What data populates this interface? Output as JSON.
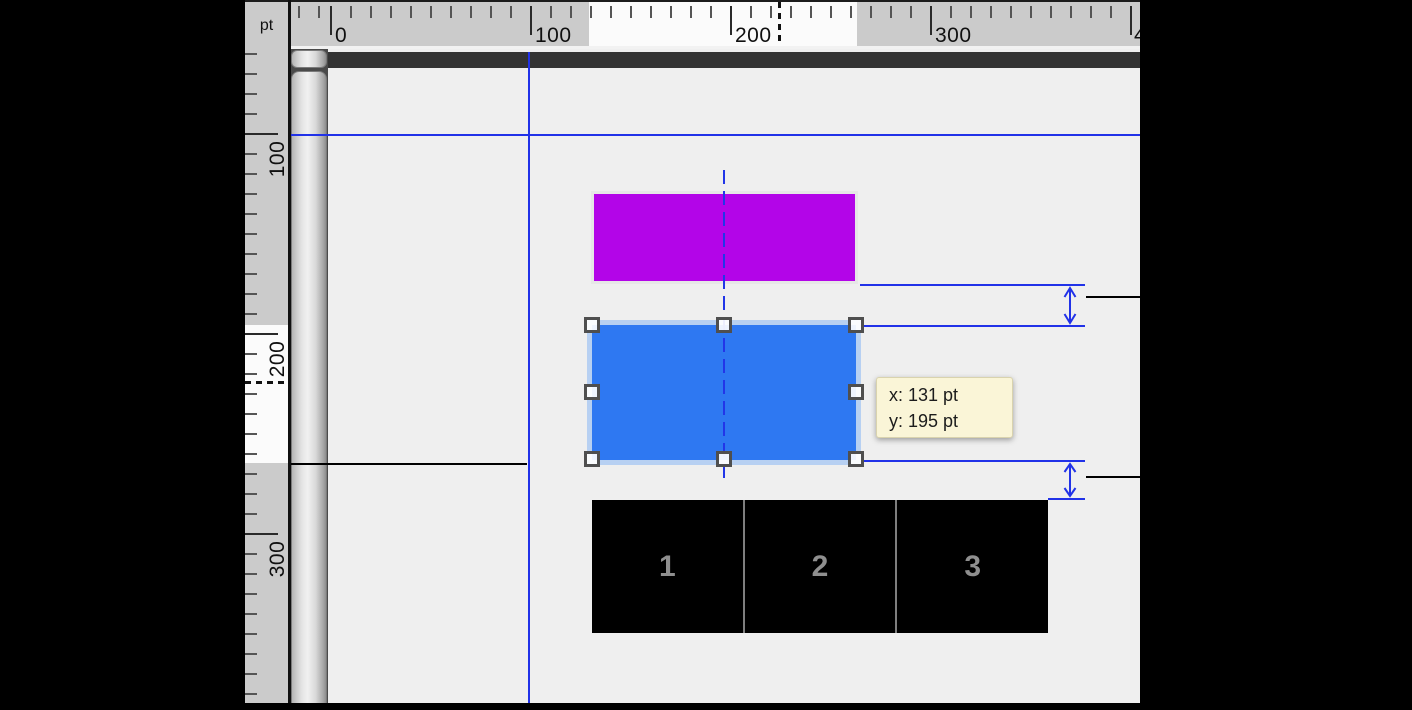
{
  "corner": {
    "unit": "pt"
  },
  "rulers": {
    "horizontal": {
      "labels": [
        "0",
        "100",
        "200",
        "300",
        "400"
      ]
    },
    "vertical": {
      "labels": [
        "100",
        "200",
        "300"
      ]
    }
  },
  "canvas": {
    "tooltip": {
      "x_line": "x: 131 pt",
      "y_line": "y: 195 pt"
    },
    "numbered_boxes": [
      {
        "label": "1"
      },
      {
        "label": "2"
      },
      {
        "label": "3"
      }
    ],
    "selection": {
      "x_pt": "131",
      "y_pt": "195"
    }
  },
  "colors": {
    "guide_blue": "#2132e8",
    "selection_fill": "#2e78f2",
    "selection_halo": "#b7d0f2",
    "magenta_fill": "#b305e8",
    "tooltip_bg": "#faf5d7",
    "page_bg": "#efefef",
    "ruler_bg": "#cbcbcb",
    "dark_bar": "#333333",
    "box_fill": "#000000",
    "box_number_gray": "#8f8f8f"
  }
}
